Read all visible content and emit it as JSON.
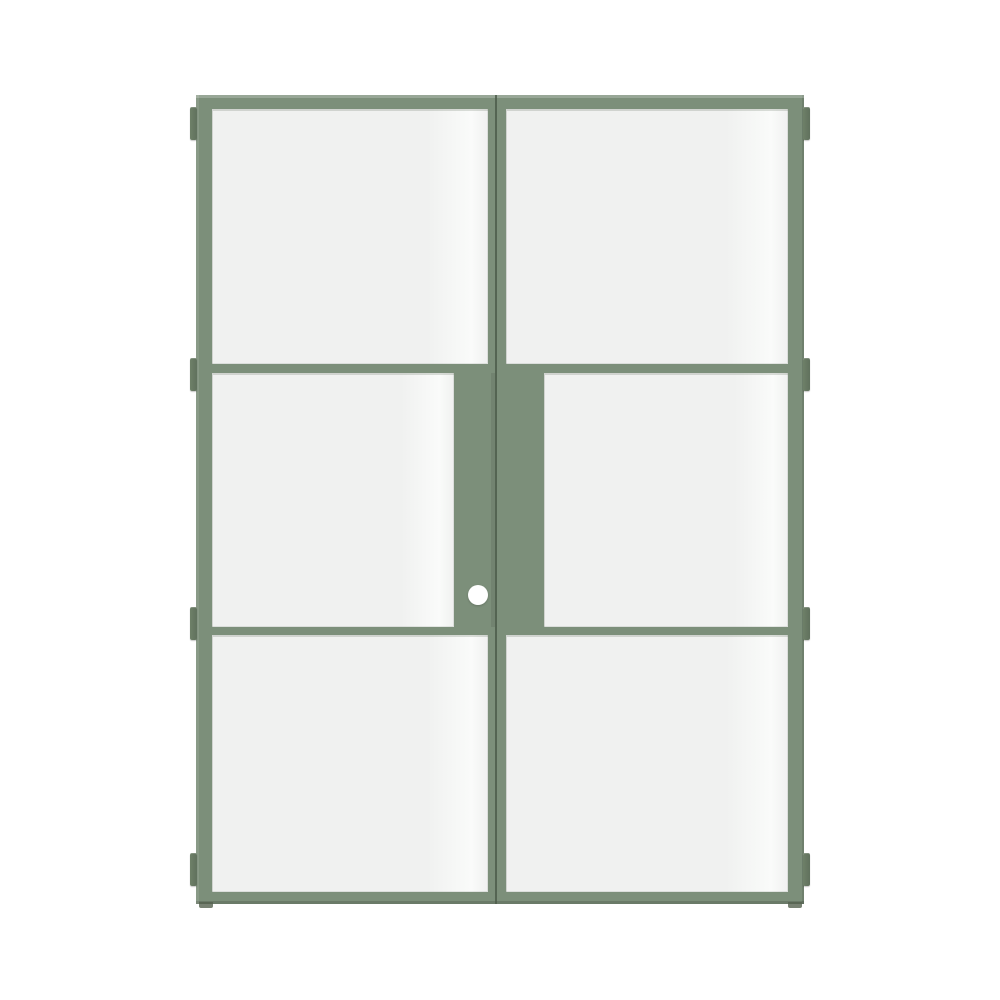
{
  "scene": {
    "type": "product-image",
    "object": "steel-framed glass double door",
    "frame_color_name": "sage green",
    "background": "white studio background",
    "door_leaves": 2,
    "glass_panes_per_leaf": 3,
    "pane_layout": "three stacked panes per leaf; middle row has wide central stiles",
    "hinges_per_side": 4,
    "hardware": "round white knob on left leaf, lower middle stile"
  },
  "parts": [
    "door-frame",
    "left-door-leaf",
    "right-door-leaf",
    "glass-pane-left-top",
    "glass-pane-left-middle",
    "glass-pane-left-bottom",
    "glass-pane-right-top",
    "glass-pane-right-middle",
    "glass-pane-right-bottom",
    "meeting-gap",
    "door-knob",
    "hinges",
    "floor-contact-shadows"
  ],
  "colors": {
    "canvas-bg": "#ffffff",
    "frame-green": "#7c8f7a",
    "frame-green-light": "#93a38f",
    "frame-green-dark": "#60715d",
    "hinge-green": "#6e8068",
    "gap-dark": "#4e5d4b",
    "glass": "#f0f1f0",
    "glass-highlight": "#fafbfa",
    "knob-white": "#ffffff",
    "contact-shadow": "#55624f"
  }
}
